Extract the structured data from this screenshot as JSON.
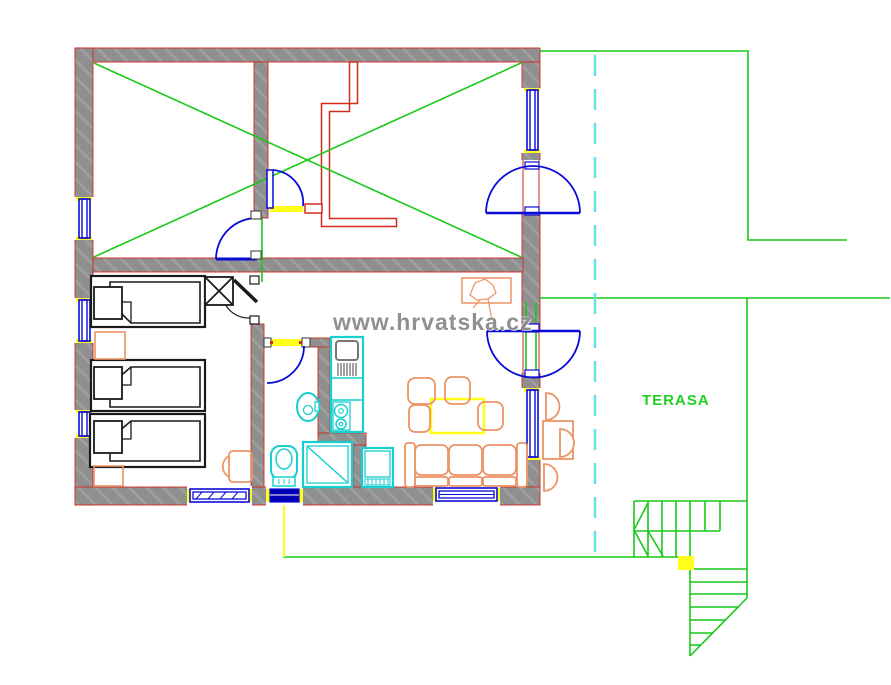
{
  "canvas": {
    "width": 891,
    "height": 685,
    "background": "#ffffff"
  },
  "labels": {
    "terrace": "TERASA",
    "watermark": "www.hrvatska.cz"
  },
  "palette": {
    "wall_gray": "#8f8f8f",
    "wall_edge_red": "#cf2a21",
    "partition_red": "#d42a1e",
    "terrace_green": "#18c918",
    "door_window_blue": "#0b0bd6",
    "window_navy": "#0000b0",
    "sanitary_cyan": "#17cfcf",
    "axis_dashed_cyan": "#63e4e4",
    "furniture_orange": "#eb9465",
    "furniture_black": "#1a1a1a",
    "accent_yellow": "#ffff19",
    "watermark_gray": "#7d7d7d",
    "terrace_label_green": "#21d121"
  }
}
